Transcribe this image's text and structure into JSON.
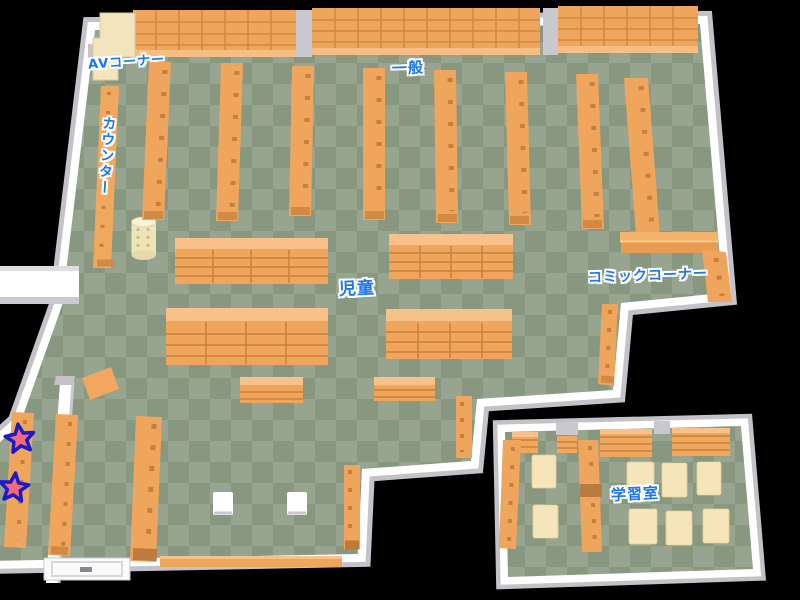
{
  "map": {
    "title": "Library floor map",
    "background_color": "#000000",
    "floor_colors": {
      "checker_light": "#96a490",
      "checker_dark": "#889780"
    },
    "accent_colors": {
      "shelf_orange": "#efa55c",
      "shelf_shadow": "#d08a44",
      "shelf_highlight": "#f7c189",
      "wall_white": "#ffffff",
      "wall_gray": "#c2c2c8",
      "desk_cream": "#f2e5be",
      "table_cream": "#f6e5ba",
      "label_blue": "#1b76f2",
      "star_pink": "#f4697b",
      "star_outline": "#1b1bc8"
    },
    "areas": {
      "av_corner": {
        "label": "AVコーナー"
      },
      "general": {
        "label": "一般"
      },
      "counter": {
        "label": "カウンター"
      },
      "children": {
        "label": "児童"
      },
      "comic_corner": {
        "label": "コミックコーナー"
      },
      "study_room": {
        "label": "学習室"
      }
    },
    "markers": {
      "star_count": 2
    }
  }
}
